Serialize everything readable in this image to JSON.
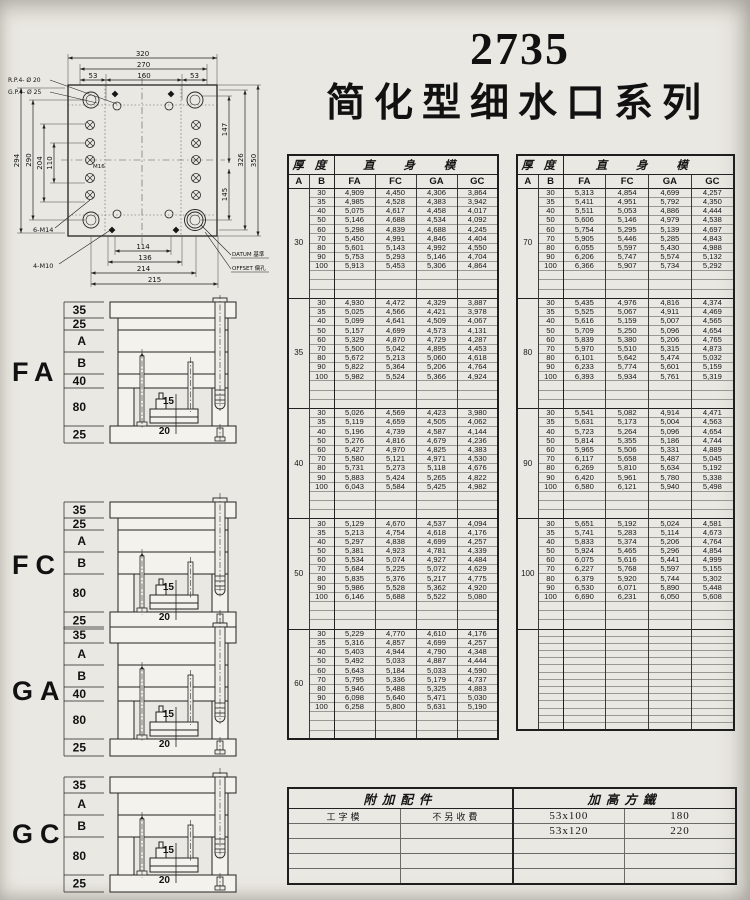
{
  "title": {
    "model": "2735",
    "series": "简化型细水口系列"
  },
  "drawing": {
    "top_dims": [
      "320",
      "270",
      "53",
      "160",
      "53"
    ],
    "left_dims": [
      "294",
      "290",
      "204",
      "110"
    ],
    "right_dims": [
      "147",
      "145",
      "326",
      "350"
    ],
    "bottom_dims": [
      "114",
      "136",
      "214",
      "215"
    ],
    "labels": {
      "rp": "R.P.4- Ø 20",
      "gp": "G.P.4- Ø 25",
      "m14": "6-M14",
      "m10": "4-M10",
      "m16": "M16",
      "datum": "DATUM 基準",
      "offset": "OFFSET 偏孔"
    }
  },
  "sections": [
    {
      "name": "FA",
      "dims": [
        "35",
        "25",
        "A",
        "B",
        "40",
        "80",
        "25"
      ],
      "inner": [
        "15",
        "20"
      ]
    },
    {
      "name": "FC",
      "dims": [
        "35",
        "25",
        "A",
        "B",
        "80",
        "25"
      ],
      "inner": [
        "15",
        "20"
      ]
    },
    {
      "name": "GA",
      "dims": [
        "35",
        "A",
        "B",
        "40",
        "80",
        "25"
      ],
      "inner": [
        "15",
        "20"
      ]
    },
    {
      "name": "GC",
      "dims": [
        "35",
        "A",
        "B",
        "80",
        "25"
      ],
      "inner": [
        "15",
        "20"
      ]
    }
  ],
  "price_table": {
    "header": {
      "thickness": "厚 度",
      "straight": "直 身 模",
      "a": "A",
      "b": "B",
      "cols": [
        "FA",
        "FC",
        "GA",
        "GC"
      ]
    },
    "left_blocks": [
      {
        "a": "30",
        "rows": [
          [
            "30",
            "4,909",
            "4,450",
            "4,306",
            "3,864"
          ],
          [
            "35",
            "4,985",
            "4,528",
            "4,383",
            "3,942"
          ],
          [
            "40",
            "5,075",
            "4,617",
            "4,458",
            "4,017"
          ],
          [
            "50",
            "5,146",
            "4,688",
            "4,534",
            "4,092"
          ],
          [
            "60",
            "5,298",
            "4,839",
            "4,688",
            "4,245"
          ],
          [
            "70",
            "5,450",
            "4,991",
            "4,846",
            "4,404"
          ],
          [
            "80",
            "5,601",
            "5,143",
            "4,992",
            "4,550"
          ],
          [
            "90",
            "5,753",
            "5,293",
            "5,146",
            "4,704"
          ],
          [
            "100",
            "5,913",
            "5,453",
            "5,306",
            "4,864"
          ]
        ]
      },
      {
        "a": "35",
        "rows": [
          [
            "30",
            "4,930",
            "4,472",
            "4,329",
            "3,887"
          ],
          [
            "35",
            "5,025",
            "4,566",
            "4,421",
            "3,978"
          ],
          [
            "40",
            "5,099",
            "4,641",
            "4,509",
            "4,067"
          ],
          [
            "50",
            "5,157",
            "4,699",
            "4,573",
            "4,131"
          ],
          [
            "60",
            "5,329",
            "4,870",
            "4,729",
            "4,287"
          ],
          [
            "70",
            "5,500",
            "5,042",
            "4,895",
            "4,453"
          ],
          [
            "80",
            "5,672",
            "5,213",
            "5,060",
            "4,618"
          ],
          [
            "90",
            "5,822",
            "5,364",
            "5,206",
            "4,764"
          ],
          [
            "100",
            "5,982",
            "5,524",
            "5,366",
            "4,924"
          ]
        ]
      },
      {
        "a": "40",
        "rows": [
          [
            "30",
            "5,026",
            "4,569",
            "4,423",
            "3,980"
          ],
          [
            "35",
            "5,119",
            "4,659",
            "4,505",
            "4,062"
          ],
          [
            "40",
            "5,196",
            "4,739",
            "4,587",
            "4,144"
          ],
          [
            "50",
            "5,276",
            "4,816",
            "4,679",
            "4,236"
          ],
          [
            "60",
            "5,427",
            "4,970",
            "4,825",
            "4,383"
          ],
          [
            "70",
            "5,580",
            "5,121",
            "4,971",
            "4,530"
          ],
          [
            "80",
            "5,731",
            "5,273",
            "5,118",
            "4,676"
          ],
          [
            "90",
            "5,883",
            "5,424",
            "5,265",
            "4,822"
          ],
          [
            "100",
            "6,043",
            "5,584",
            "5,425",
            "4,982"
          ]
        ]
      },
      {
        "a": "50",
        "rows": [
          [
            "30",
            "5,129",
            "4,670",
            "4,537",
            "4,094"
          ],
          [
            "35",
            "5,213",
            "4,754",
            "4,618",
            "4,176"
          ],
          [
            "40",
            "5,297",
            "4,838",
            "4,699",
            "4,257"
          ],
          [
            "50",
            "5,381",
            "4,923",
            "4,781",
            "4,339"
          ],
          [
            "60",
            "5,534",
            "5,074",
            "4,927",
            "4,484"
          ],
          [
            "70",
            "5,684",
            "5,225",
            "5,072",
            "4,629"
          ],
          [
            "80",
            "5,835",
            "5,376",
            "5,217",
            "4,775"
          ],
          [
            "90",
            "5,986",
            "5,528",
            "5,362",
            "4,920"
          ],
          [
            "100",
            "6,146",
            "5,688",
            "5,522",
            "5,080"
          ]
        ]
      },
      {
        "a": "60",
        "rows": [
          [
            "30",
            "5,229",
            "4,770",
            "4,610",
            "4,176"
          ],
          [
            "35",
            "5,316",
            "4,857",
            "4,699",
            "4,257"
          ],
          [
            "40",
            "5,403",
            "4,944",
            "4,790",
            "4,348"
          ],
          [
            "50",
            "5,492",
            "5,033",
            "4,887",
            "4,444"
          ],
          [
            "60",
            "5,643",
            "5,184",
            "5,033",
            "4,590"
          ],
          [
            "70",
            "5,795",
            "5,336",
            "5,179",
            "4,737"
          ],
          [
            "80",
            "5,946",
            "5,488",
            "5,325",
            "4,883"
          ],
          [
            "90",
            "6,098",
            "5,640",
            "5,471",
            "5,030"
          ],
          [
            "100",
            "6,258",
            "5,800",
            "5,631",
            "5,190"
          ]
        ]
      }
    ],
    "right_blocks": [
      {
        "a": "70",
        "rows": [
          [
            "30",
            "5,313",
            "4,854",
            "4,699",
            "4,257"
          ],
          [
            "35",
            "5,411",
            "4,951",
            "5,792",
            "4,350"
          ],
          [
            "40",
            "5,511",
            "5,053",
            "4,886",
            "4,444"
          ],
          [
            "50",
            "5,606",
            "5,146",
            "4,979",
            "4,538"
          ],
          [
            "60",
            "5,754",
            "5,295",
            "5,139",
            "4,697"
          ],
          [
            "70",
            "5,905",
            "5,446",
            "5,285",
            "4,843"
          ],
          [
            "80",
            "6,055",
            "5,597",
            "5,430",
            "4,988"
          ],
          [
            "90",
            "6,206",
            "5,747",
            "5,574",
            "5,132"
          ],
          [
            "100",
            "6,366",
            "5,907",
            "5,734",
            "5,292"
          ]
        ]
      },
      {
        "a": "80",
        "rows": [
          [
            "30",
            "5,435",
            "4,976",
            "4,816",
            "4,374"
          ],
          [
            "35",
            "5,525",
            "5,067",
            "4,911",
            "4,469"
          ],
          [
            "40",
            "5,616",
            "5,159",
            "5,007",
            "4,565"
          ],
          [
            "50",
            "5,709",
            "5,250",
            "5,096",
            "4,654"
          ],
          [
            "60",
            "5,839",
            "5,380",
            "5,206",
            "4,765"
          ],
          [
            "70",
            "5,970",
            "5,510",
            "5,315",
            "4,873"
          ],
          [
            "80",
            "6,101",
            "5,642",
            "5,474",
            "5,032"
          ],
          [
            "90",
            "6,233",
            "5,774",
            "5,601",
            "5,159"
          ],
          [
            "100",
            "6,393",
            "5,934",
            "5,761",
            "5,319"
          ]
        ]
      },
      {
        "a": "90",
        "rows": [
          [
            "30",
            "5,541",
            "5,082",
            "4,914",
            "4,471"
          ],
          [
            "35",
            "5,631",
            "5,173",
            "5,004",
            "4,563"
          ],
          [
            "40",
            "5,723",
            "5,264",
            "5,096",
            "4,654"
          ],
          [
            "50",
            "5,814",
            "5,355",
            "5,186",
            "4,744"
          ],
          [
            "60",
            "5,965",
            "5,506",
            "5,331",
            "4,889"
          ],
          [
            "70",
            "6,117",
            "5,658",
            "5,487",
            "5,045"
          ],
          [
            "80",
            "6,269",
            "5,810",
            "5,634",
            "5,192"
          ],
          [
            "90",
            "6,420",
            "5,961",
            "5,780",
            "5,338"
          ],
          [
            "100",
            "6,580",
            "6,121",
            "5,940",
            "5,498"
          ]
        ]
      },
      {
        "a": "100",
        "rows": [
          [
            "30",
            "5,651",
            "5,192",
            "5,024",
            "4,581"
          ],
          [
            "35",
            "5,741",
            "5,283",
            "5,114",
            "4,673"
          ],
          [
            "40",
            "5,833",
            "5,374",
            "5,206",
            "4,764"
          ],
          [
            "50",
            "5,924",
            "5,465",
            "5,296",
            "4,854"
          ],
          [
            "60",
            "6,075",
            "5,616",
            "5,441",
            "4,999"
          ],
          [
            "70",
            "6,227",
            "5,768",
            "5,597",
            "5,155"
          ],
          [
            "80",
            "6,379",
            "5,920",
            "5,744",
            "5,302"
          ],
          [
            "90",
            "6,530",
            "6,071",
            "5,890",
            "5,448"
          ],
          [
            "100",
            "6,690",
            "6,231",
            "6,050",
            "5,608"
          ]
        ]
      }
    ]
  },
  "bottom_table": {
    "left_header": "附加配件",
    "right_header": "加高方鐵",
    "row1": [
      "工字模",
      "不另收費"
    ],
    "right_rows": [
      [
        "53x100",
        "180"
      ],
      [
        "53x120",
        "220"
      ]
    ]
  }
}
